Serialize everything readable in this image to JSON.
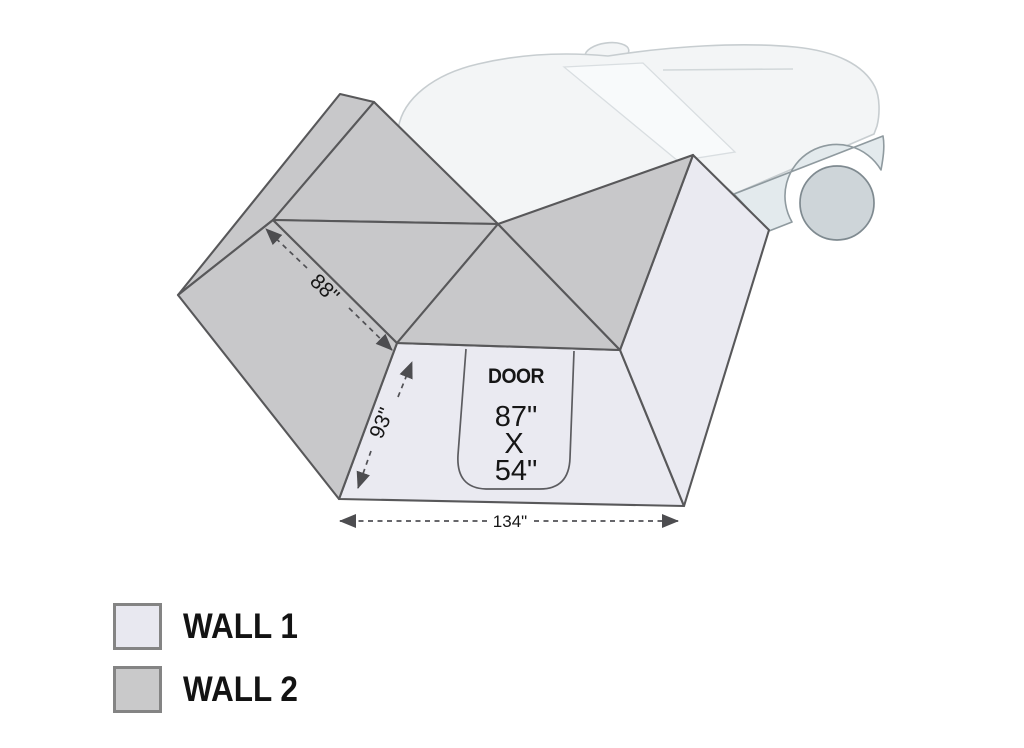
{
  "diagram": {
    "door": {
      "label": "DOOR",
      "height": "87\"",
      "separator": "X",
      "width": "54\""
    },
    "dimensions": {
      "roof_edge": "88\"",
      "front_edge": "93\"",
      "base_width": "134\""
    }
  },
  "legend": {
    "items": [
      {
        "label": "WALL 1",
        "color": "#e8e8f0"
      },
      {
        "label": "WALL 2",
        "color": "#c9c9ca"
      }
    ]
  },
  "colors": {
    "wall1": "#eaeaf1",
    "wall2": "#c8c8ca",
    "outline": "#58585a",
    "car_body": "#f3f5f6",
    "car_glass": "#f8fafb",
    "car_fender": "#e3eaed",
    "car_wheel": "#ced5d9"
  }
}
